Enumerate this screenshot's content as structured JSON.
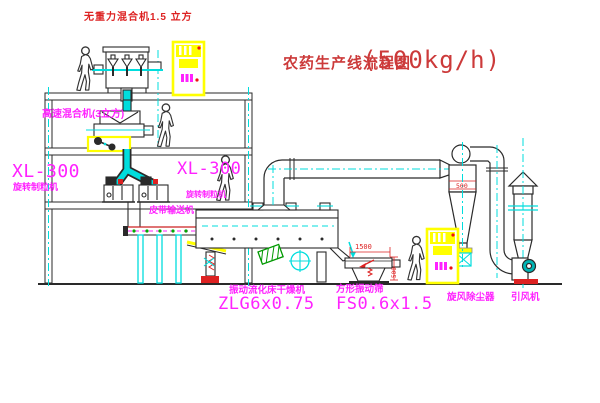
{
  "title": {
    "text": "农药生产线流程图",
    "capacity": "(500kg/h)"
  },
  "labels": {
    "gravity_mixer": "无重力混合机1.5 立方",
    "high_speed_mixer": "高速混合机(3立方)",
    "granulator_left_model": "XL-300",
    "granulator_left_name": "旋转制粒机",
    "granulator_mid_model": "XL-300",
    "granulator_mid_name": "旋转制粒机",
    "belt_conveyor": "皮带输送机",
    "dryer_name": "振动流化床干燥机",
    "dryer_model": "ZLG6x0.75",
    "screen_name": "方形振动筛",
    "screen_model": "FS0.6x1.5",
    "cyclone_name": "旋风除尘器",
    "fan_name": "引风机"
  },
  "dimensions": {
    "screen_length": "1500",
    "screen_height": "500",
    "cyclone_outlet": "500"
  },
  "colors": {
    "annotation_magenta": "#ff22ff",
    "title_red": "#cc3a3a",
    "centerline_cyan": "#00dddd",
    "highlight_yellow": "#ffff00",
    "dimension_red": "#dd2222",
    "line_black": "#2a2a2a"
  }
}
